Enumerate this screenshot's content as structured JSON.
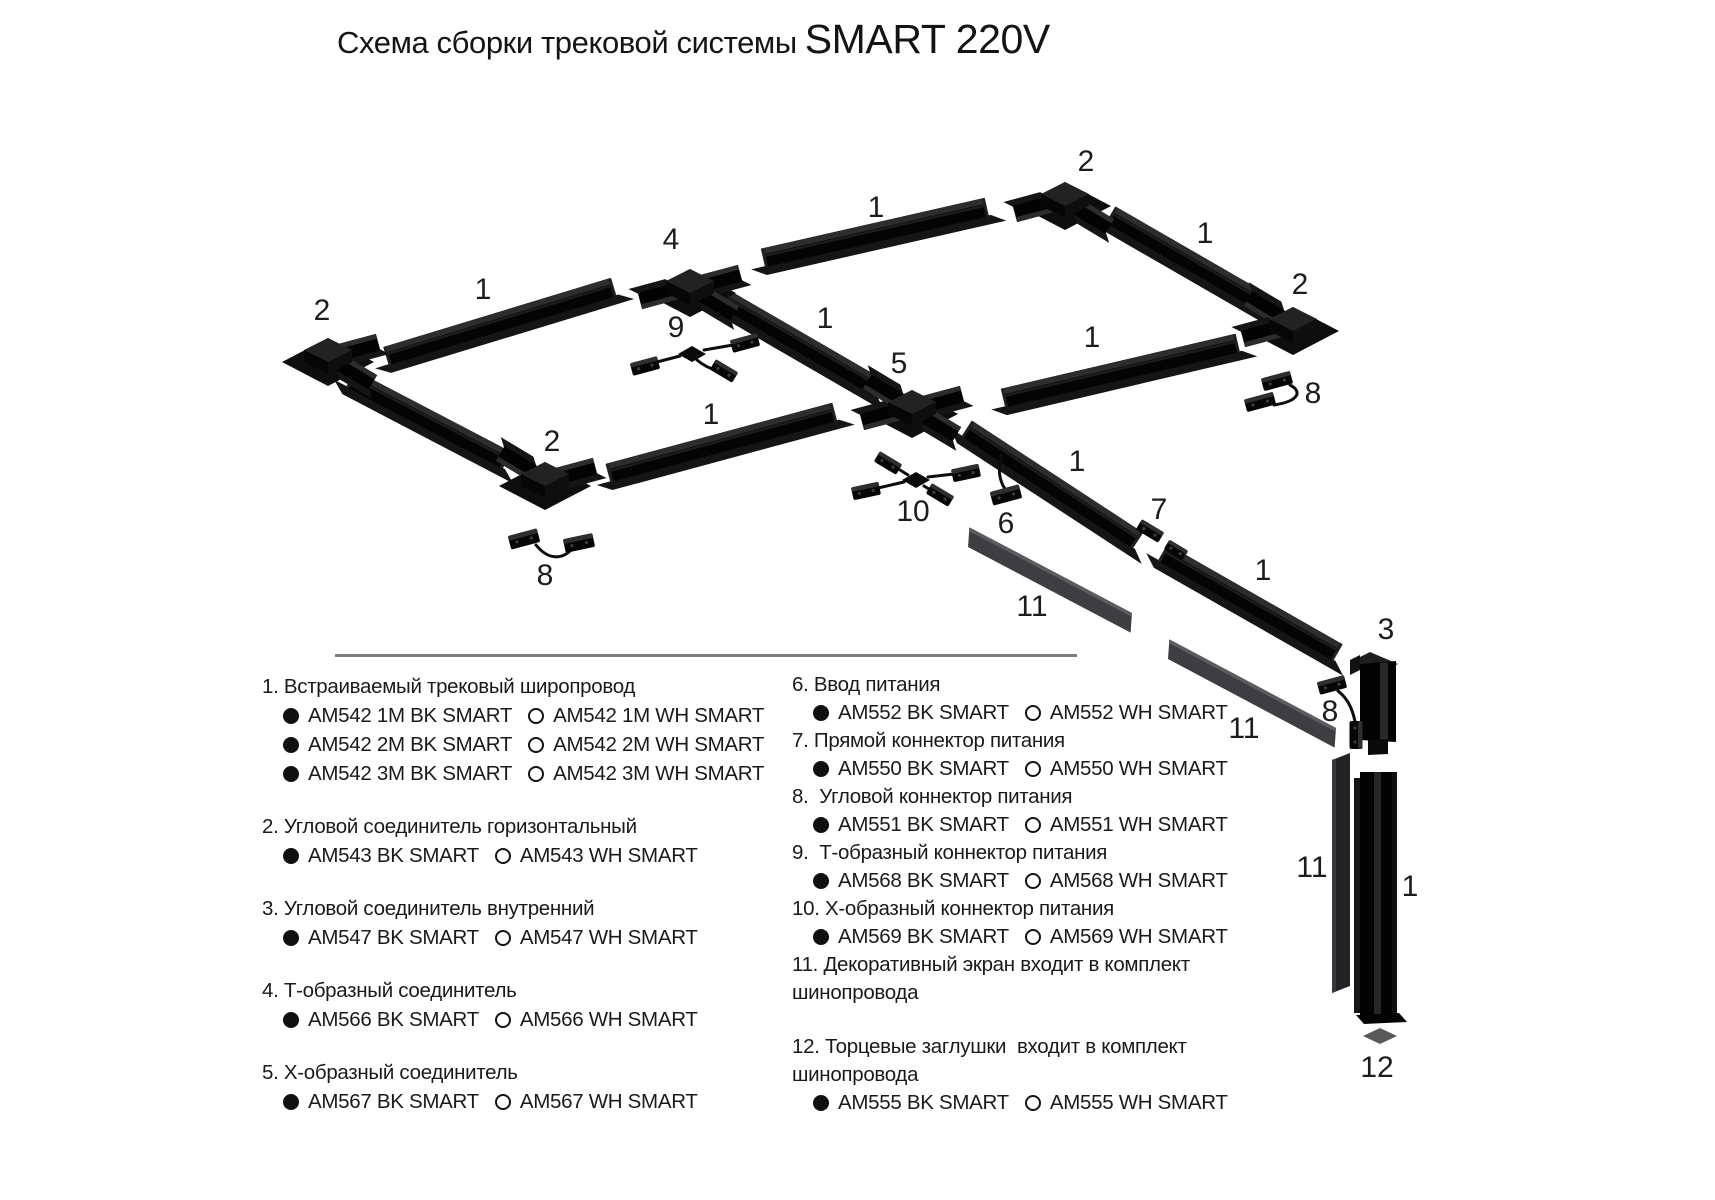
{
  "title": {
    "prefix": "Схема сборки трековой системы",
    "brand": "SMART 220V"
  },
  "colors": {
    "track_body": "#040404",
    "track_top": "#2d2d2d",
    "track_flange": "#151515",
    "screen": "#3d3d42",
    "screen_edge": "#5b5b60",
    "endcap": "#58585a",
    "divider": "#7d7d7d",
    "text": "#1a1a1a",
    "callout": "#1c1c1c"
  },
  "diagram": {
    "divider": {
      "x": 335,
      "y": 654,
      "w": 742,
      "h": 3
    },
    "tracks": [
      {
        "x1": 388,
        "y1": 356,
        "x2": 612,
        "y2": 288
      },
      {
        "x1": 765,
        "y1": 258,
        "x2": 985,
        "y2": 208
      },
      {
        "x1": 1112,
        "y1": 216,
        "x2": 1268,
        "y2": 306
      },
      {
        "x1": 1005,
        "y1": 398,
        "x2": 1236,
        "y2": 344
      },
      {
        "x1": 352,
        "y1": 380,
        "x2": 505,
        "y2": 460
      },
      {
        "x1": 610,
        "y1": 473,
        "x2": 833,
        "y2": 413
      },
      {
        "x1": 726,
        "y1": 300,
        "x2": 878,
        "y2": 388
      },
      {
        "x1": 968,
        "y1": 430,
        "x2": 1136,
        "y2": 540
      },
      {
        "x1": 1164,
        "y1": 554,
        "x2": 1336,
        "y2": 652
      }
    ],
    "vertical_track": {
      "x": 1360,
      "y": 772,
      "w": 37,
      "h": 245
    },
    "screens": [
      {
        "x1": 974,
        "y1": 540,
        "x2": 1126,
        "y2": 620
      },
      {
        "x1": 1174,
        "y1": 652,
        "x2": 1330,
        "y2": 735
      }
    ],
    "vertical_screen": {
      "x": 1332,
      "y": 753,
      "w": 18,
      "h": 240
    },
    "connectors": [
      {
        "kind": "corner-horizontal",
        "x": 328,
        "y": 356,
        "stubs": [
          -15,
          31
        ]
      },
      {
        "kind": "corner-horizontal",
        "x": 1065,
        "y": 200,
        "stubs": [
          165,
          31
        ]
      },
      {
        "kind": "corner-horizontal",
        "x": 1293,
        "y": 325,
        "stubs": [
          211,
          165
        ]
      },
      {
        "kind": "corner-horizontal",
        "x": 545,
        "y": 480,
        "stubs": [
          211,
          -15
        ]
      },
      {
        "kind": "tee",
        "x": 690,
        "y": 287,
        "stubs": [
          165,
          -15,
          31
        ]
      },
      {
        "kind": "cross",
        "x": 912,
        "y": 408,
        "stubs": [
          165,
          -15,
          31,
          211
        ]
      }
    ],
    "inner_corner": {
      "x": 1350,
      "y": 648
    },
    "endcap": {
      "x": 1380,
      "y": 1036
    },
    "power_boxes": [
      {
        "x": 1006,
        "y": 495,
        "rot": -15,
        "w": 30,
        "h": 14
      },
      {
        "x": 1150,
        "y": 531,
        "rot": 31,
        "w": 26,
        "h": 12
      },
      {
        "x": 1176,
        "y": 550,
        "rot": 31,
        "w": 22,
        "h": 11
      },
      {
        "x": 524,
        "y": 539,
        "rot": -15,
        "w": 30,
        "h": 14
      },
      {
        "x": 579,
        "y": 543,
        "rot": -12,
        "w": 30,
        "h": 14
      },
      {
        "x": 1277,
        "y": 381,
        "rot": -15,
        "w": 30,
        "h": 13
      },
      {
        "x": 1260,
        "y": 402,
        "rot": -15,
        "w": 30,
        "h": 13
      },
      {
        "x": 1332,
        "y": 685,
        "rot": -15,
        "w": 28,
        "h": 13
      },
      {
        "x": 1356,
        "y": 735,
        "rot": 90,
        "w": 28,
        "h": 13
      },
      {
        "x": 645,
        "y": 366,
        "rot": -15,
        "w": 28,
        "h": 13
      },
      {
        "x": 745,
        "y": 343,
        "rot": -15,
        "w": 28,
        "h": 13
      },
      {
        "x": 724,
        "y": 371,
        "rot": 31,
        "w": 26,
        "h": 12
      },
      {
        "x": 866,
        "y": 491,
        "rot": -12,
        "w": 28,
        "h": 13
      },
      {
        "x": 966,
        "y": 473,
        "rot": -12,
        "w": 28,
        "h": 13
      },
      {
        "x": 888,
        "y": 463,
        "rot": 31,
        "w": 26,
        "h": 12
      },
      {
        "x": 940,
        "y": 495,
        "rot": 31,
        "w": 26,
        "h": 12
      }
    ],
    "power_hubs": [
      {
        "x": 692,
        "y": 354
      },
      {
        "x": 916,
        "y": 480
      }
    ],
    "cables": [
      "M1001,455 C998,468 999,480 1005,489",
      "M536,545 C548,560 562,560 572,549",
      "M1290,385 C1302,391 1300,401 1274,405",
      "M1338,691 C1350,700 1354,714 1356,727",
      "M657,362 L680,356",
      "M704,350 L733,345",
      "M697,360 C704,366 712,369 716,370",
      "M878,488 L904,482",
      "M928,477 L954,474",
      "M900,470 L908,475",
      "M924,486 L932,491"
    ],
    "callouts": [
      {
        "text": "2",
        "x": 322,
        "y": 309
      },
      {
        "text": "1",
        "x": 483,
        "y": 288
      },
      {
        "text": "4",
        "x": 671,
        "y": 238
      },
      {
        "text": "1",
        "x": 876,
        "y": 206
      },
      {
        "text": "2",
        "x": 1086,
        "y": 160
      },
      {
        "text": "1",
        "x": 1205,
        "y": 232
      },
      {
        "text": "2",
        "x": 1300,
        "y": 283
      },
      {
        "text": "9",
        "x": 676,
        "y": 326
      },
      {
        "text": "1",
        "x": 825,
        "y": 317
      },
      {
        "text": "5",
        "x": 899,
        "y": 362
      },
      {
        "text": "1",
        "x": 711,
        "y": 413
      },
      {
        "text": "2",
        "x": 552,
        "y": 440
      },
      {
        "text": "1",
        "x": 1092,
        "y": 336
      },
      {
        "text": "8",
        "x": 1313,
        "y": 392
      },
      {
        "text": "10",
        "x": 913,
        "y": 510
      },
      {
        "text": "6",
        "x": 1006,
        "y": 522
      },
      {
        "text": "1",
        "x": 1077,
        "y": 460
      },
      {
        "text": "7",
        "x": 1159,
        "y": 508
      },
      {
        "text": "8",
        "x": 545,
        "y": 574
      },
      {
        "text": "11",
        "x": 1032,
        "y": 605
      },
      {
        "text": "1",
        "x": 1263,
        "y": 569
      },
      {
        "text": "3",
        "x": 1386,
        "y": 628
      },
      {
        "text": "8",
        "x": 1330,
        "y": 710
      },
      {
        "text": "11",
        "x": 1244,
        "y": 727
      },
      {
        "text": "11",
        "x": 1312,
        "y": 866
      },
      {
        "text": "1",
        "x": 1410,
        "y": 885
      },
      {
        "text": "12",
        "x": 1377,
        "y": 1066
      }
    ]
  },
  "legend": {
    "left": [
      {
        "title_lines": [
          "1. Встраиваемый трековый широпровод"
        ],
        "variants": [
          [
            "AM542 1M BK SMART",
            "AM542 1M WH SMART"
          ],
          [
            "AM542 2M BK SMART",
            "AM542 2M WH SMART"
          ],
          [
            "AM542 3M BK SMART",
            "AM542 3M WH SMART"
          ]
        ]
      },
      {
        "title_lines": [
          "2. Угловой соединитель горизонтальный"
        ],
        "variants": [
          [
            "AM543 BK SMART",
            "AM543 WH SMART"
          ]
        ]
      },
      {
        "title_lines": [
          "3. Угловой соединитель внутренний"
        ],
        "variants": [
          [
            "AM547 BK SMART",
            "AM547 WH SMART"
          ]
        ]
      },
      {
        "title_lines": [
          "4. Т-образный соединитель"
        ],
        "variants": [
          [
            "AM566 BK SMART",
            "AM566 WH SMART"
          ]
        ]
      },
      {
        "title_lines": [
          "5. Х-образный соединитель"
        ],
        "variants": [
          [
            "AM567 BK SMART",
            "AM567 WH SMART"
          ]
        ]
      }
    ],
    "right": [
      {
        "title_lines": [
          "6. Ввод питания"
        ],
        "variants": [
          [
            "AM552 BK SMART",
            "AM552 WH SMART"
          ]
        ]
      },
      {
        "title_lines": [
          "7. Прямой коннектор питания"
        ],
        "variants": [
          [
            "AM550 BK SMART",
            "AM550 WH SMART"
          ]
        ]
      },
      {
        "title_lines": [
          "8.  Угловой коннектор питания"
        ],
        "variants": [
          [
            "AM551 BK SMART",
            "AM551 WH SMART"
          ]
        ]
      },
      {
        "title_lines": [
          "9.  Т-образный коннектор питания"
        ],
        "variants": [
          [
            "AM568 BK SMART",
            "AM568 WH SMART"
          ]
        ]
      },
      {
        "title_lines": [
          "10. Х-образный коннектор питания"
        ],
        "variants": [
          [
            "AM569 BK SMART",
            "AM569 WH SMART"
          ]
        ]
      },
      {
        "title_lines": [
          "11. Декоративный экран входит в комплект",
          "шинопровода"
        ],
        "variants": []
      },
      {
        "title_lines": [
          "12. Торцевые заглушки  входит в комплект",
          "шинопровода"
        ],
        "variants": [
          [
            "AM555 BK SMART",
            "AM555 WH SMART"
          ]
        ],
        "gap_before": true
      }
    ]
  }
}
